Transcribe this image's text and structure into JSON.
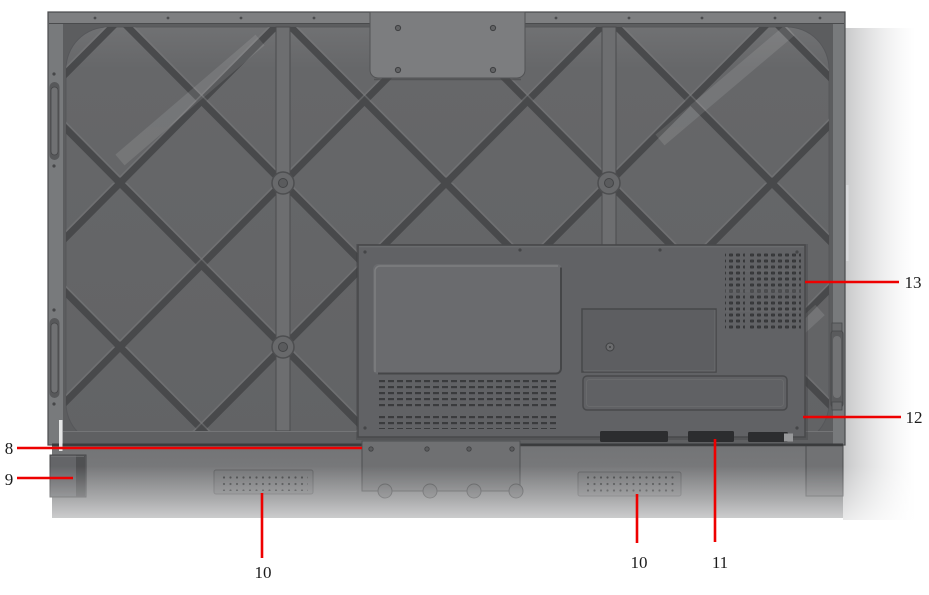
{
  "diagram": {
    "name": "display-rear-view-callout-diagram",
    "accent_color": "#ee0000",
    "label_color": "#1b1b1b",
    "background_color": "#ffffff",
    "panel_color": "#646567",
    "callouts": [
      {
        "label": "8"
      },
      {
        "label": "9"
      },
      {
        "label": "10"
      },
      {
        "label": "10"
      },
      {
        "label": "11"
      },
      {
        "label": "12"
      },
      {
        "label": "13"
      }
    ]
  }
}
